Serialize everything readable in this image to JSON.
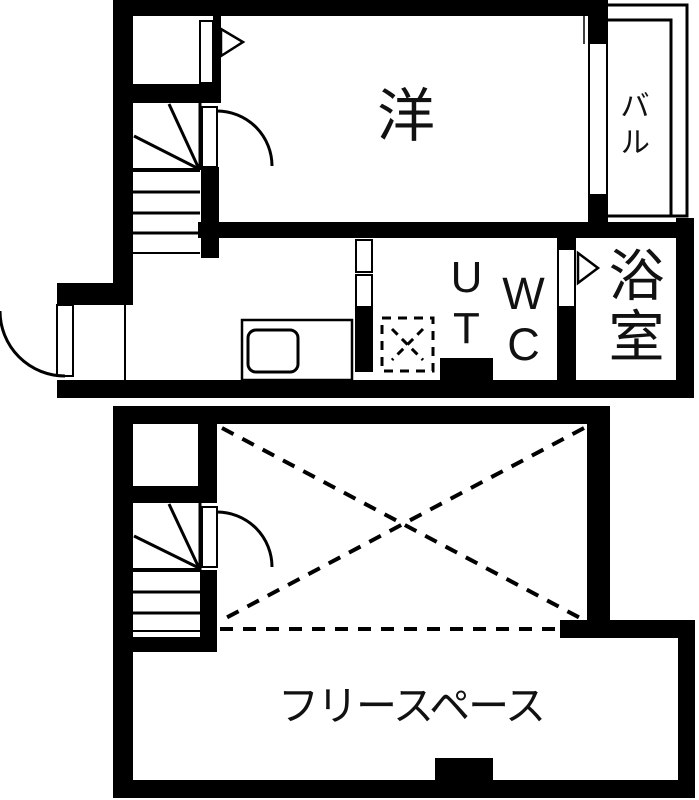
{
  "floor_plan": {
    "background": "#ffffff",
    "line_color": "#000000",
    "upper_floor": {
      "rooms": {
        "western_room": "洋",
        "balcony": "バル",
        "utility": "UT",
        "toilet": "WC",
        "bathroom": "浴室"
      }
    },
    "lower_floor": {
      "rooms": {
        "free_space": "フリースペース"
      }
    }
  }
}
